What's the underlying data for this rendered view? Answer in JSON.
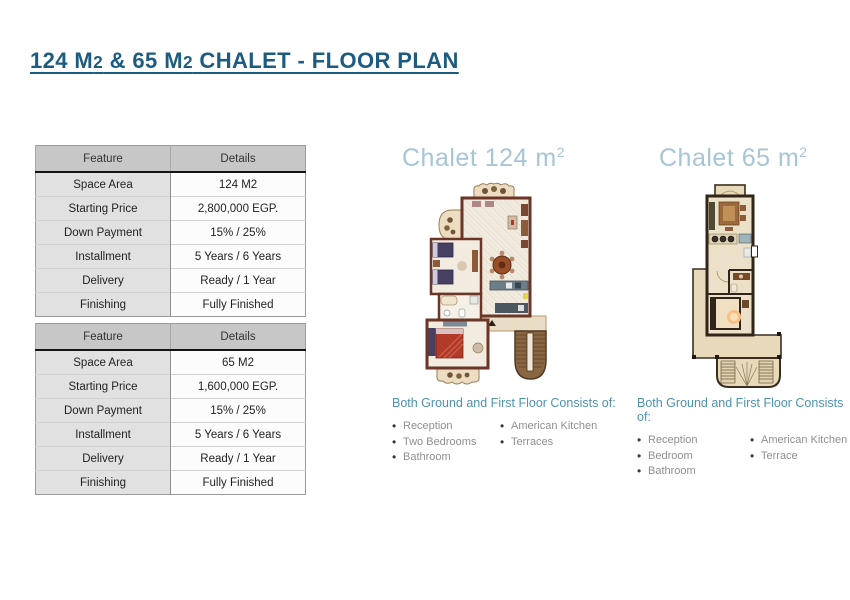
{
  "title": {
    "part1": "124 M",
    "part2": "2",
    "part3": " & 65 M",
    "part4": "2",
    "part5": " CHALET - FLOOR PLAN"
  },
  "tables": [
    {
      "name": "chalet-124-spec-table",
      "headers": [
        "Feature",
        "Details"
      ],
      "rows": [
        [
          "Space Area",
          "124 M2"
        ],
        [
          "Starting Price",
          "2,800,000 EGP."
        ],
        [
          "Down Payment",
          "15% / 25%"
        ],
        [
          "Installment",
          "5 Years / 6 Years"
        ],
        [
          "Delivery",
          "Ready / 1 Year"
        ],
        [
          "Finishing",
          "Fully Finished"
        ]
      ]
    },
    {
      "name": "chalet-65-spec-table",
      "headers": [
        "Feature",
        "Details"
      ],
      "rows": [
        [
          "Space Area",
          "65 M2"
        ],
        [
          "Starting Price",
          "1,600,000 EGP."
        ],
        [
          "Down Payment",
          "15% / 25%"
        ],
        [
          "Installment",
          "5 Years / 6 Years"
        ],
        [
          "Delivery",
          "Ready / 1 Year"
        ],
        [
          "Finishing",
          "Fully Finished"
        ]
      ]
    }
  ],
  "plans": [
    {
      "heading_text": "Chalet 124 m",
      "heading_sup": "2",
      "list_title": "Both Ground and First Floor Consists of:",
      "items_col1": [
        "Reception",
        "Two Bedrooms",
        "Bathroom"
      ],
      "items_col2": [
        "American Kitchen",
        "Terraces"
      ]
    },
    {
      "heading_text": "Chalet 65 m",
      "heading_sup": "2",
      "list_title": "Both Ground and First Floor Consists of:",
      "items_col1": [
        "Reception",
        "Bedroom",
        "Bathroom"
      ],
      "items_col2": [
        "American Kitchen",
        "Terrace"
      ]
    }
  ],
  "colors": {
    "title_blue": "#1d5c80",
    "heading_light_blue": "#a7c5d5",
    "list_title_blue": "#4d93b0",
    "list_item_gray": "#8f8f8f",
    "table_header_bg": "#c7c7c7",
    "table_feature_bg": "#e1e1e1",
    "plan124_wall": "#6b3527",
    "plan65_wall": "#31251a",
    "plan_floor": "#ece0c8",
    "terrace": "#e8d9ba"
  }
}
